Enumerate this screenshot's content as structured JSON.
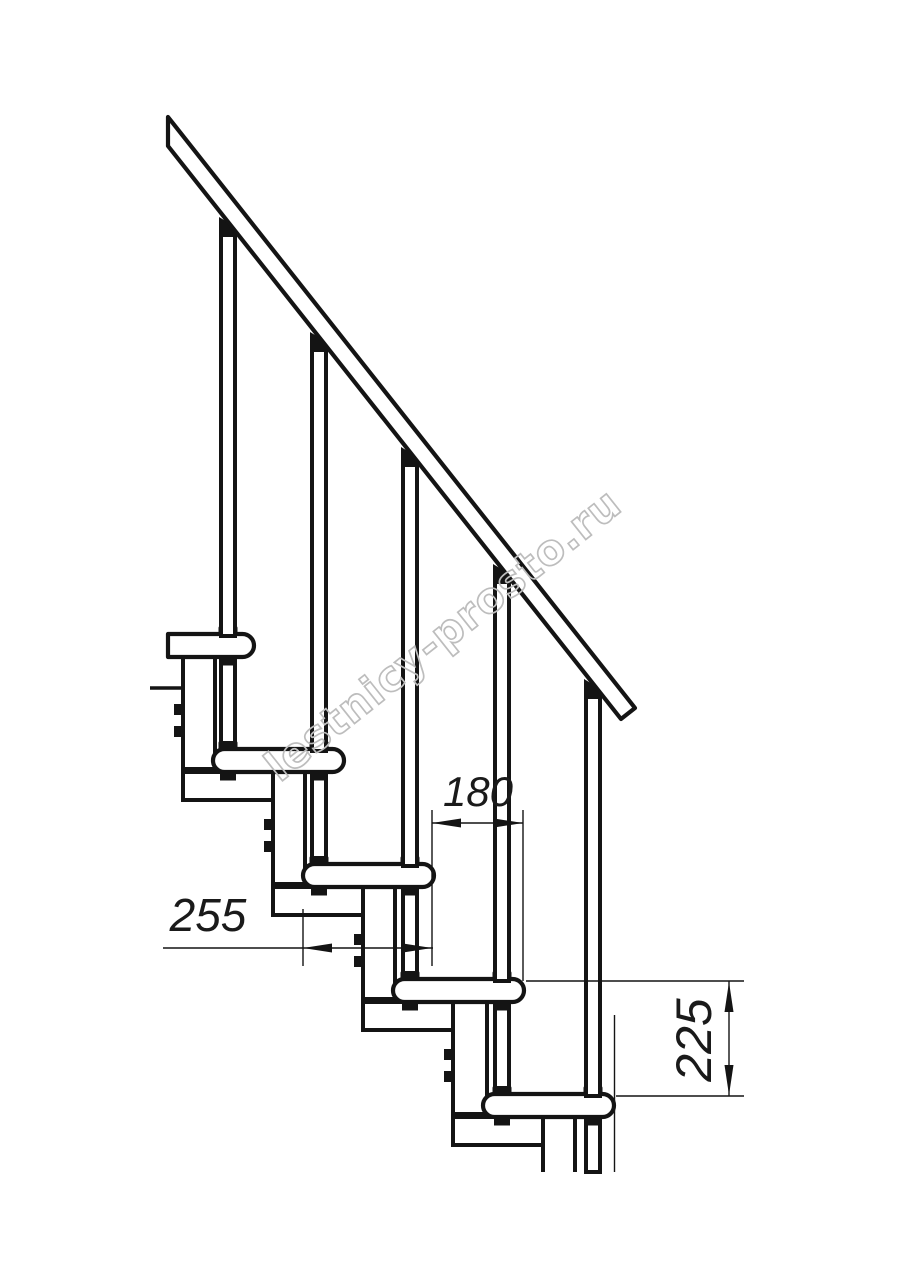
{
  "drawing": {
    "watermark": {
      "text": "lestnicy-prosto.ru",
      "color": "#bdbdbd"
    },
    "dimensions": {
      "tread_depth_label": "255",
      "step_run_label": "180",
      "step_rise_label": "225"
    },
    "colors": {
      "line": "#141414",
      "background": "#ffffff"
    },
    "components": {
      "tread_count": 5,
      "baluster_count": 5,
      "handrail_count": 1
    }
  }
}
